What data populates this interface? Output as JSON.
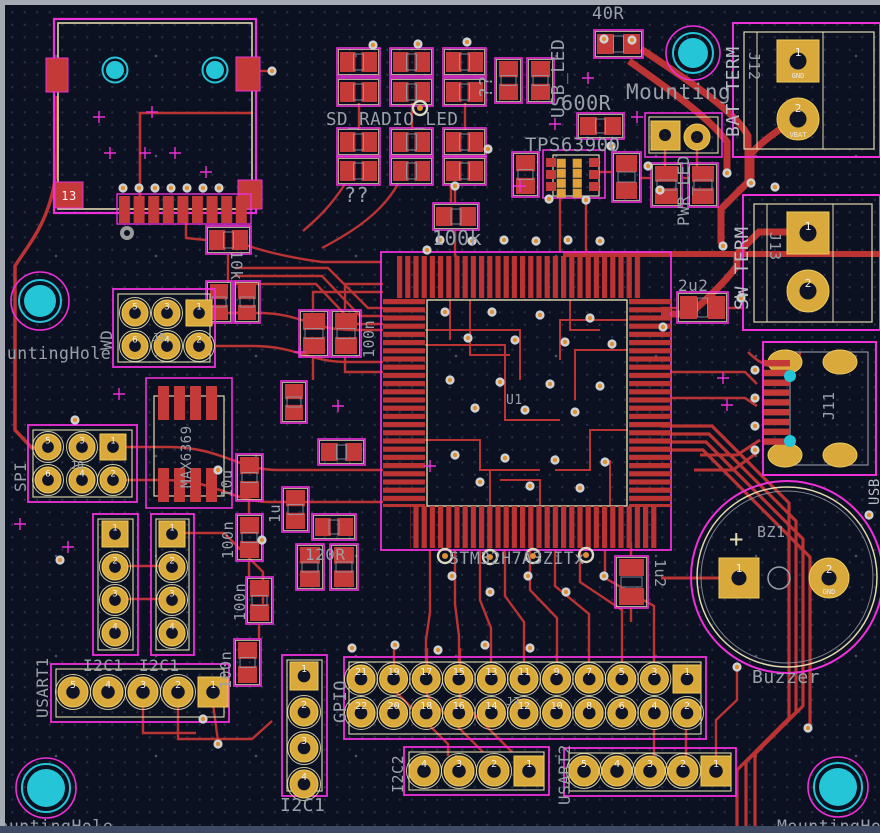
{
  "app": {
    "title": "PCB layout editor canvas"
  },
  "colors": {
    "background": "#0c1122",
    "copper_red": "#bb3333",
    "pad_gold": "#d9a93c",
    "courtyard_magenta": "#ee30d8",
    "silkscreen_cream": "#e0d9ad",
    "fab_text_gray": "#9aa0a8",
    "hole_cyan": "#25c5d8",
    "via_ring": "#cfd2d4",
    "via_center": "#de9030"
  },
  "labels": {
    "sd_radio_led": "SD_RADIO_LED",
    "unknown1": "??",
    "unknown2": "??",
    "r40": "40R",
    "r600": "600R",
    "usb_led": "USB_LED",
    "tps": "TPS63900",
    "mounting_top": "Mounting",
    "pwr_led": "PWR_LED",
    "r100k": "100k",
    "r10k": "10k",
    "c2u2": "2u2",
    "c1u2": "1u2",
    "c1u": "1u",
    "r120": "120R",
    "c10u": "10u",
    "c100n": "100n",
    "u1_ref": "U1",
    "u1_val": "STM32H7A3ZITx",
    "max": "MAX6369",
    "wd": "WD",
    "j5": "J5",
    "spi": "SPI",
    "j8": "J8",
    "i2c1": "I2C1",
    "usart1": "USART1",
    "gpio": "GPIO",
    "j7": "J7",
    "i2c2": "I2C2",
    "usart2": "USART2",
    "j11": "J11",
    "j12": "J12",
    "bat_term": "BAT TERM",
    "j13": "J13",
    "sw_term": "SW TERM",
    "bz1": "BZ1",
    "buzzer": "Buzzer",
    "plus": "+",
    "mh": "MountingHole",
    "usb_note": "USB"
  },
  "pads": {
    "j12": {
      "p1": "1",
      "p1_name": "GND",
      "p2": "2",
      "p2_name": "VBAT"
    },
    "j13": {
      "p1": "1",
      "p2": "2"
    },
    "buzzer": {
      "p1": "1",
      "p2": "2",
      "p2_name": "GND"
    },
    "jumper": {
      "p1": "1",
      "p2": "2"
    },
    "module": {
      "p13": "13"
    }
  },
  "pin_numbers": {
    "gpio_top": [
      "21",
      "19",
      "17",
      "15",
      "13",
      "11",
      "9",
      "7",
      "5",
      "3",
      "1"
    ],
    "gpio_bottom": [
      "22",
      "20",
      "18",
      "16",
      "14",
      "12",
      "10",
      "8",
      "6",
      "4",
      "2"
    ],
    "usart": [
      "5",
      "4",
      "3",
      "2",
      "1"
    ],
    "i2c2": [
      "4",
      "3",
      "2",
      "1"
    ],
    "i2c1": [
      "1",
      "2",
      "3",
      "4"
    ],
    "dual3_top": [
      "5",
      "3",
      "1"
    ],
    "dual3_bottom": [
      "6",
      "4",
      "2"
    ]
  }
}
